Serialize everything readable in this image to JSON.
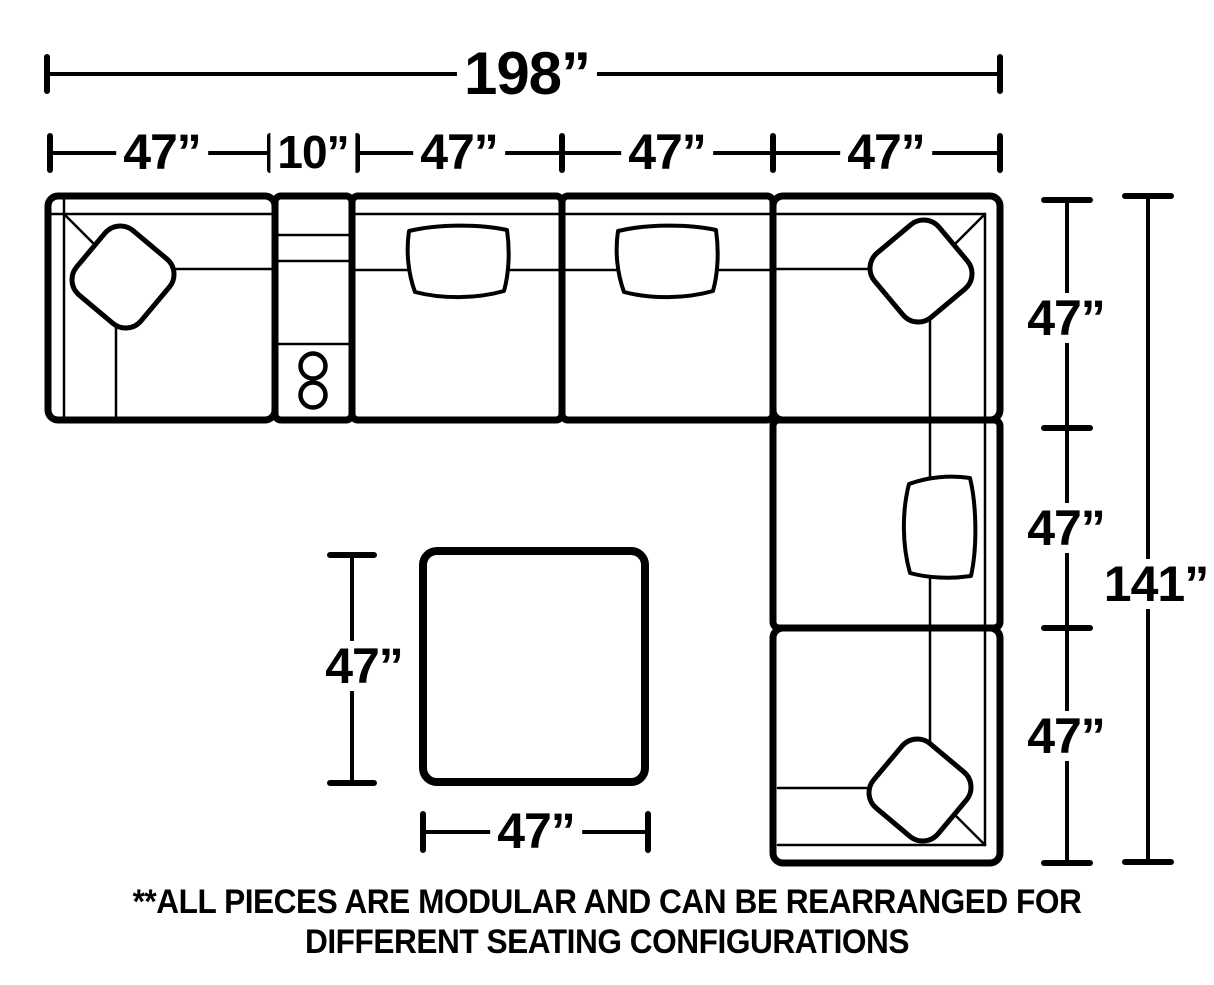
{
  "dimensions": {
    "overall_width": "198”",
    "top_row": [
      "47”",
      "10”",
      "47”",
      "47”",
      "47”"
    ],
    "right_column": [
      "47”",
      "47”",
      "47”"
    ],
    "overall_height": "141”",
    "ottoman_height": "47”",
    "ottoman_width": "47”"
  },
  "note": {
    "line1": "**ALL PIECES ARE MODULAR AND CAN BE REARRANGED FOR",
    "line2": "DIFFERENT SEATING CONFIGURATIONS"
  },
  "colors": {
    "line": "#000000",
    "background": "#ffffff"
  }
}
